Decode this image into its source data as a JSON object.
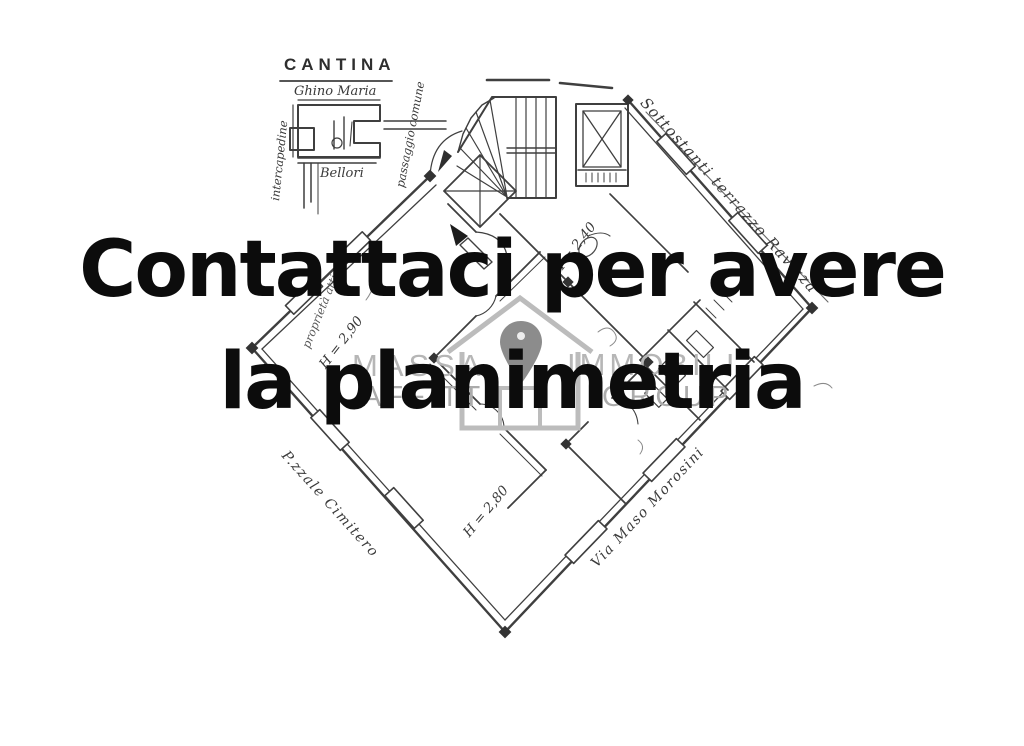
{
  "canvas": {
    "background": "#ffffff",
    "ink_color": "#3f3f3f",
    "pencil_color": "#8a8a8a"
  },
  "overlay": {
    "line1": "Contattaci per avere",
    "line2": "la planimetria",
    "color": "#0c0c0c"
  },
  "watermark": {
    "top_left": "MASSA",
    "top_right": "IMMOBILI",
    "bottom_left": "AFFITTI",
    "bottom_right": "GROUP",
    "pin_color": "#8c8c8c",
    "house_color": "#bcbcbc",
    "text_color": "#b6b6b6"
  },
  "floorplan": {
    "cantina": {
      "title": "CANTINA",
      "subtitle": "Ghino Maria",
      "left_label": "intercapedine",
      "right_label": "passaggio comune",
      "bottom_label": "Bellori"
    },
    "streets": {
      "top_right": "Sottostanti terrazzo Ravizza",
      "bottom_left": "P.zzale Cimitero",
      "bottom_right": "Via Maso Morosini"
    },
    "heights": {
      "h1": "H = 2,90",
      "h2": "H = 2,40",
      "h3": "H = 2,80"
    },
    "note_left": "proprietà attigua"
  }
}
